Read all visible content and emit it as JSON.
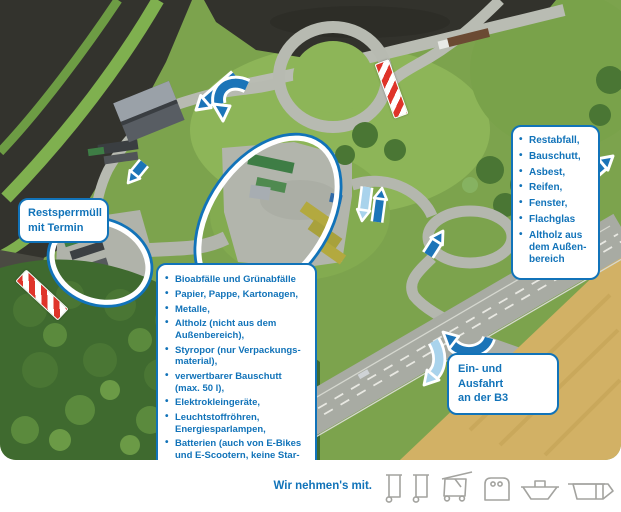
{
  "boxes": {
    "restsperrmuell": {
      "text": "Restsperrmüll\nmit Termin"
    },
    "accepted": {
      "items": [
        "Bioabfälle und Grünabfälle",
        "Papier, Pappe, Kartonagen,",
        "Metalle,",
        "Altholz (nicht aus dem\nAußenbereich),",
        "Styropor (nur Verpackungs-\nmaterial),",
        "verwertbarer Bauschutt\n(max. 50 l),",
        "Elektrokleingeräte,",
        "Leuchtstoffröhren,\nEnergiesparlampen,",
        "Batterien (auch von E-Bikes\nund E-Scootern, keine Star-\nterbatterien),",
        "Druckerpatronen,",
        "CDs und DVDs,",
        "Altkleider und Schuhe"
      ]
    },
    "restricted": {
      "items": [
        "Restabfall,",
        "Bauschutt,",
        "Asbest,",
        "Reifen,",
        "Fenster,",
        "Flachglas",
        "Altholz aus\ndem Außen-\nbereich"
      ]
    },
    "entrance": {
      "text": "Ein- und Ausfahrt\nan der B3"
    }
  },
  "footer": {
    "label": "Wir nehmen's mit.",
    "icons": [
      "wheelie-bin-icon",
      "wheelie-bin-icon",
      "open-lid-container-icon",
      "front-load-container-icon",
      "skip-container-icon",
      "roll-off-container-icon"
    ]
  },
  "colors": {
    "accent_blue": "#1173b9",
    "light_blue": "#a9d3ec",
    "barrier_red": "#df342a",
    "icon_gray": "#a3a39f"
  }
}
